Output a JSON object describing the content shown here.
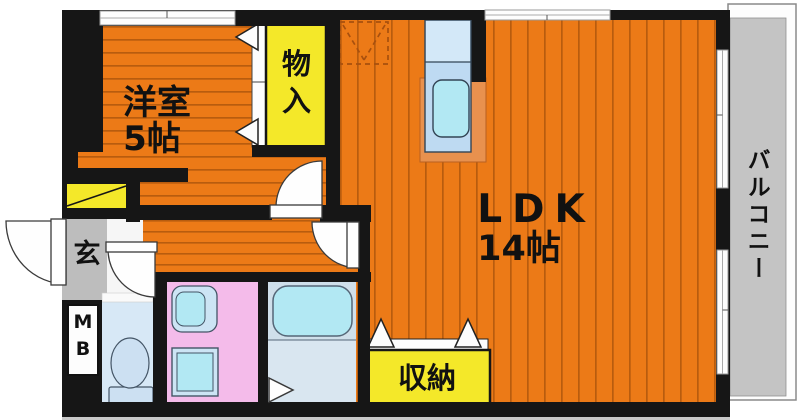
{
  "labels": {
    "western_room_name": "洋室",
    "western_room_size": "5帖",
    "closet": "物入",
    "ldk_name": "LDK",
    "ldk_size": "14帖",
    "storage": "収納",
    "entrance": "玄",
    "meter_box": "MB",
    "balcony": "バルコニー"
  },
  "colors": {
    "floor_orange": "#EC7A17",
    "floor_stripe": "#B85C0E",
    "accent_yellow": "#F4E829",
    "washroom_pink": "#F4BBEA",
    "entrance_gray": "#BDBDBD",
    "balcony_gray": "#C4C4C4",
    "bathroom_floor": "#D9E6F0",
    "fixture_cyan": "#B2E8F3",
    "fixture_blue": "#CCE0F2",
    "counter_blue": "#BEDAF2",
    "kitchen_salmon": "#E8914E",
    "wall_black": "#161616"
  },
  "fixtures": [
    "window",
    "door-swing",
    "folding-door",
    "kitchen-sink",
    "refrigerator-space",
    "bathtub",
    "washbasin",
    "washing-machine-space",
    "toilet",
    "shoe-cabinet",
    "meter-box"
  ]
}
